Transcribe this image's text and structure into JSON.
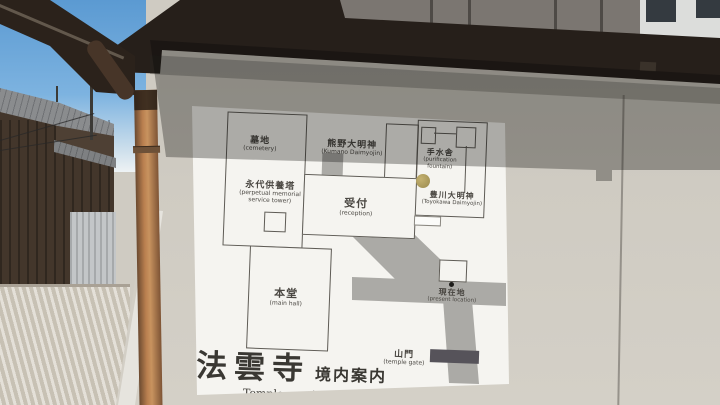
{
  "sign": {
    "temple_name_jp": "法雲寺",
    "map_title_jp": "境内案内",
    "map_title_en": "Temple precincts",
    "locations": {
      "cemetery": {
        "jp": "墓地",
        "en": "(cemetery)"
      },
      "memorial_tower": {
        "jp": "永代供養塔",
        "en_line1": "(perpetual memorial",
        "en_line2": "service tower)"
      },
      "kumano_daimyojin": {
        "jp": "熊野大明神",
        "en": "(Kumano Daimyojin)"
      },
      "chozuya": {
        "jp": "手水舎",
        "en_line1": "(purification",
        "en_line2": "fountain)"
      },
      "toyokawa_daimyojin": {
        "jp": "豊川大明神",
        "en": "(Toyokawa Daimyojin)"
      },
      "reception": {
        "jp": "受付",
        "en": "(reception)"
      },
      "main_hall": {
        "jp": "本堂",
        "en": "(main hall)"
      },
      "current_location": {
        "jp": "現在地",
        "en": "(present location)"
      },
      "sanmon_gate": {
        "jp": "山門",
        "en": "(temple gate)"
      }
    }
  },
  "colors": {
    "sky": "#5b9ad2",
    "eave": "#261f1a",
    "building": "#7b7671",
    "white-building": "#dcdddb",
    "house-wall": "#43362b",
    "roof": "#8a8c8e",
    "fence": "#c3c6c8",
    "ground": "#d2cbbe",
    "wall": "#cfcbc2",
    "board": "#f5f4f0",
    "path": "#abaaa6",
    "outline": "#5e5b55",
    "ink": "#4a4742",
    "marker": "#9a8a4e",
    "gate-bar": "#56535a",
    "pipe": "#b97f4f"
  }
}
